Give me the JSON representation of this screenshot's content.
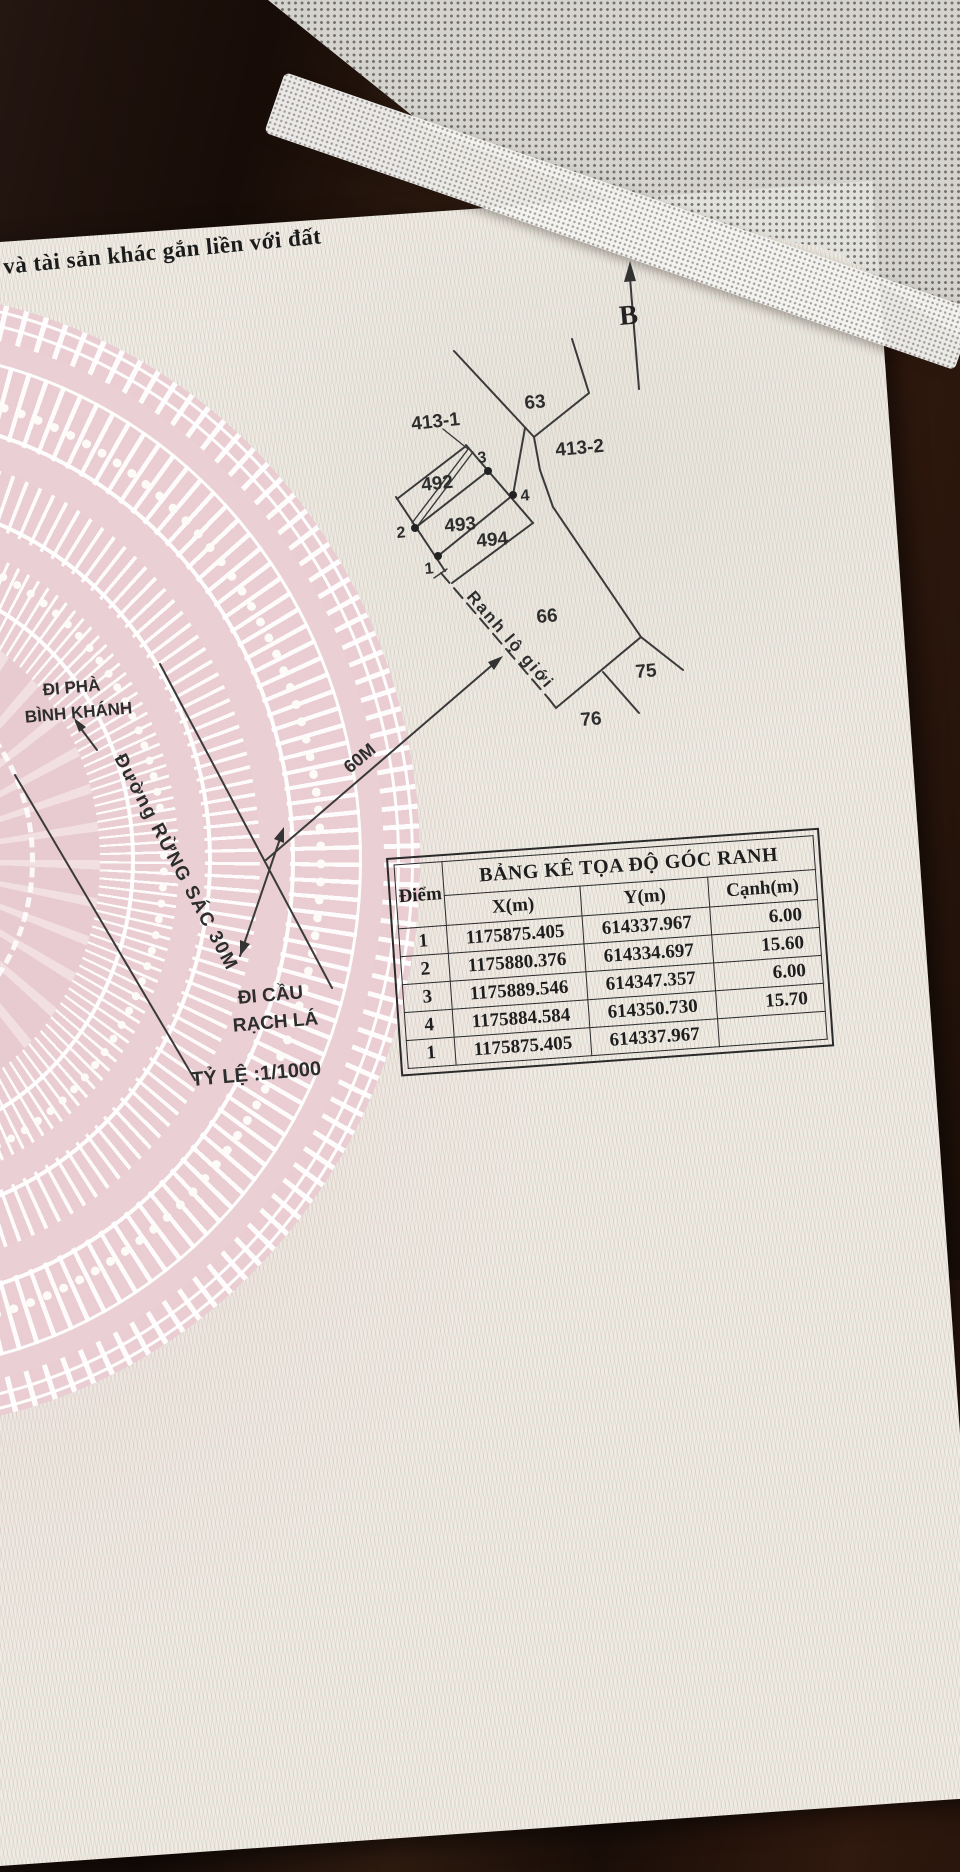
{
  "page": {
    "headline": "và tài sản khác gắn liền với đất"
  },
  "map": {
    "north_label": "B",
    "parcels": {
      "p63": "63",
      "p413_1": "413-1",
      "p413_2": "413-2",
      "p492": "492",
      "p493": "493",
      "p494": "494",
      "p66": "66",
      "p75": "75",
      "p76": "76"
    },
    "points": {
      "p1": "1",
      "p2": "2",
      "p3": "3",
      "p4": "4"
    },
    "boundary_label": "Ranh lộ giới",
    "dim_60": "60M",
    "road_label": "Đường RỪNG SÁC 30M",
    "dir_ferry_line1": "ĐI PHÀ",
    "dir_ferry_line2": "BÌNH KHÁNH",
    "dir_bridge_line1": "ĐI CẦU",
    "dir_bridge_line2": "RẠCH LÁ",
    "scale_label": "TỶ LỆ :1/1000"
  },
  "table": {
    "title": "BẢNG KÊ TỌA ĐỘ GÓC RANH",
    "columns": [
      "Điểm",
      "X(m)",
      "Y(m)",
      "Cạnh(m)"
    ],
    "rows": [
      [
        "1",
        "1175875.405",
        "614337.967",
        "6.00"
      ],
      [
        "2",
        "1175880.376",
        "614334.697",
        "15.60"
      ],
      [
        "3",
        "1175889.546",
        "614347.357",
        "6.00"
      ],
      [
        "4",
        "1175884.584",
        "614350.730",
        "15.70"
      ],
      [
        "1",
        "1175875.405",
        "614337.967",
        ""
      ]
    ]
  },
  "colors": {
    "paper": "#efece4",
    "ink": "#2d2d2d",
    "drum_pink": "#e9cdd2",
    "wood": "#24140c",
    "mesh": "#e2e2de",
    "table_line": "#2a2a2a"
  }
}
